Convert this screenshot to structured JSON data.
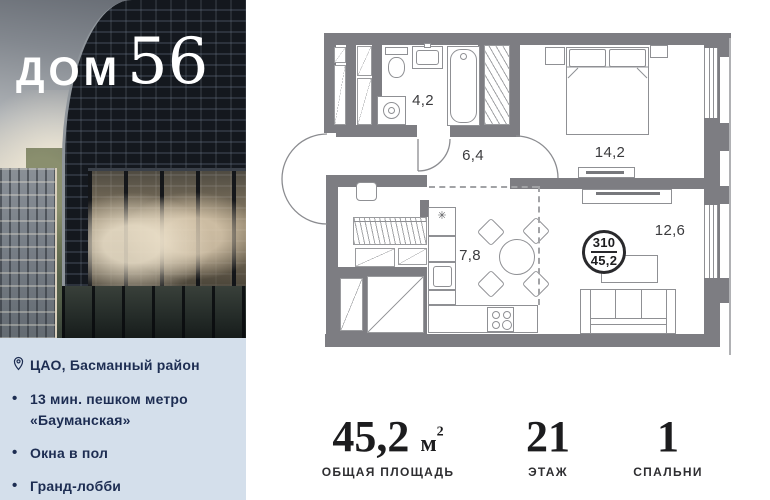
{
  "logo": {
    "word": "ДОМ",
    "number": "56"
  },
  "info_panel": {
    "bullet": "•",
    "location": "ЦАО, Басманный район",
    "features": [
      "13 мин. пешком метро «Бауманская»",
      "Окна в пол",
      "Гранд-лобби"
    ]
  },
  "floor_plan": {
    "rooms": [
      {
        "name": "bathroom",
        "area": "4,2"
      },
      {
        "name": "hallway",
        "area": "6,4"
      },
      {
        "name": "bedroom",
        "area": "14,2"
      },
      {
        "name": "kitchen_dining",
        "area": "7,8"
      },
      {
        "name": "living",
        "area": "12,6"
      }
    ],
    "badge": {
      "number": "310",
      "area": "45,2"
    },
    "fridge_symbol": "✳"
  },
  "stats": [
    {
      "value": "45,2",
      "unit": "м",
      "sup": "2",
      "label": "ОБЩАЯ ПЛОЩАДЬ"
    },
    {
      "value": "21",
      "unit": "",
      "sup": "",
      "label": "ЭТАЖ"
    },
    {
      "value": "1",
      "unit": "",
      "sup": "",
      "label": "СПАЛЬНИ"
    }
  ],
  "colors": {
    "wall": "#7d7d82",
    "line": "#8f9094",
    "panel_bg": "#d4dfeb",
    "panel_text": "#1d2d52"
  }
}
